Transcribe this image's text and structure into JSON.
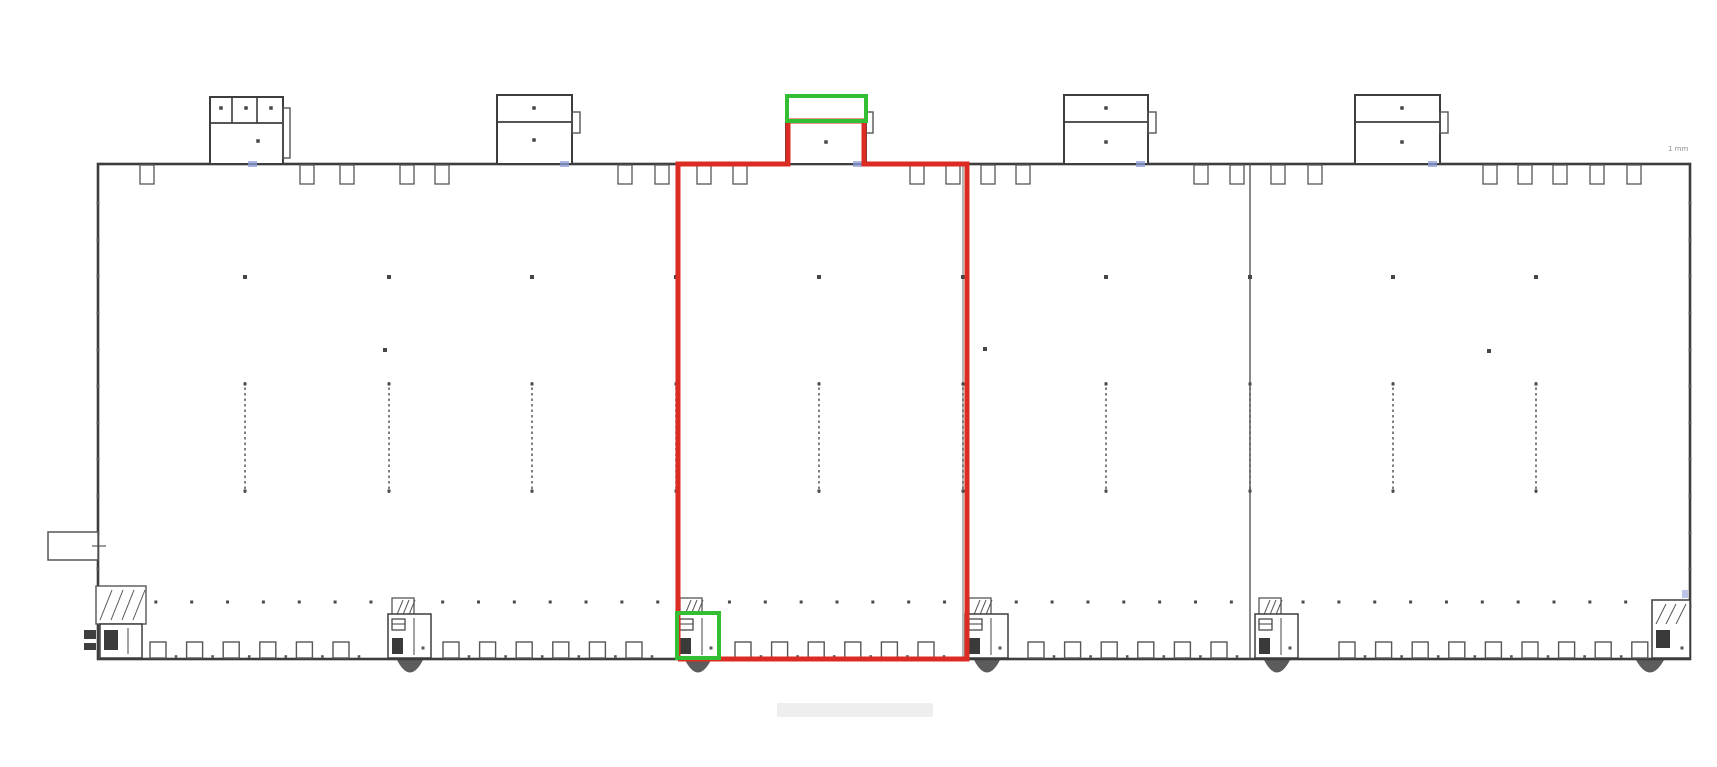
{
  "canvas": {
    "width": 1717,
    "height": 767,
    "background": "#ffffff"
  },
  "colors": {
    "wall": "#3d3d3d",
    "detail": "#565656",
    "light": "#7a7a7a",
    "highlight_red": "#dc2b23",
    "highlight_green": "#33bf33",
    "dim_blue": "#8f9fd8",
    "ghost": "#ececec",
    "note": "#8f8f8f"
  },
  "note": {
    "corner_label": "1 mm"
  },
  "building": {
    "left": 98,
    "top": 164,
    "right": 1690,
    "bottom": 659,
    "partition_x": 1250,
    "hidden_partitions": [
      676,
      963
    ]
  },
  "offices": [
    {
      "x": 210,
      "y": 97,
      "w": 73,
      "div_y": 123,
      "room_x": [
        232,
        257
      ],
      "dots": [
        [
          221,
          108
        ],
        [
          246,
          108
        ],
        [
          271,
          108
        ],
        [
          258,
          141
        ]
      ],
      "bump": {
        "x": 283,
        "y": 108,
        "w": 7,
        "h": 50
      }
    },
    {
      "x": 497,
      "y": 95,
      "w": 75,
      "div_y": 122,
      "room_x": [],
      "dots": [
        [
          534,
          108
        ],
        [
          534,
          140
        ]
      ],
      "bump": {
        "x": 572,
        "y": 112,
        "w": 8,
        "h": 21
      }
    },
    {
      "x": 786,
      "y": 95,
      "w": 80,
      "div_y": 122,
      "room_x": [],
      "dots": [
        [
          826,
          142
        ]
      ],
      "bump": {
        "x": 866,
        "y": 112,
        "w": 7,
        "h": 21
      }
    },
    {
      "x": 1064,
      "y": 95,
      "w": 84,
      "div_y": 122,
      "room_x": [],
      "dots": [
        [
          1106,
          108
        ],
        [
          1106,
          142
        ]
      ],
      "bump": {
        "x": 1148,
        "y": 112,
        "w": 8,
        "h": 21
      }
    },
    {
      "x": 1355,
      "y": 95,
      "w": 85,
      "div_y": 122,
      "room_x": [],
      "dots": [
        [
          1402,
          108
        ],
        [
          1402,
          142
        ]
      ],
      "bump": {
        "x": 1440,
        "y": 112,
        "w": 8,
        "h": 21
      }
    }
  ],
  "top_notches": {
    "w": 14,
    "h": 19,
    "xs": [
      140,
      300,
      340,
      400,
      435,
      618,
      655,
      697,
      733,
      910,
      946,
      981,
      1016,
      1194,
      1230,
      1271,
      1308,
      1483,
      1518,
      1553,
      1590,
      1627
    ]
  },
  "dock_doors": {
    "w": 16,
    "h": 17,
    "top_y": 642,
    "runs": [
      {
        "start": 150,
        "pitch": 36.6,
        "count": 6
      },
      {
        "start": 443,
        "pitch": 36.6,
        "count": 6
      },
      {
        "start": 735,
        "pitch": 36.6,
        "count": 6
      },
      {
        "start": 1028,
        "pitch": 36.6,
        "count": 6
      },
      {
        "start": 1339,
        "pitch": 36.6,
        "count": 9
      }
    ]
  },
  "rack_lines": {
    "y1": 382,
    "y2": 493,
    "xs": [
      245,
      389,
      532,
      676,
      819,
      963,
      1106,
      1250,
      1393,
      1536
    ]
  },
  "module_dots": {
    "y": 277
  },
  "sparse_dots": [
    [
      385,
      350
    ],
    [
      985,
      349
    ],
    [
      1489,
      351
    ]
  ],
  "bottom_dots": {
    "y": 602,
    "start": 120,
    "pitch": 35.85,
    "count": 44
  },
  "wall_ticks": {
    "ys": [
      203,
      240,
      276,
      313,
      350,
      386,
      423,
      459,
      496,
      533,
      569,
      606
    ]
  },
  "stairs_units": {
    "xs": [
      390,
      678,
      967,
      1257
    ]
  },
  "corner_left": {
    "hatch": {
      "x": 96,
      "y": 586,
      "w": 50,
      "h": 38
    },
    "box": {
      "x": 100,
      "y": 624,
      "w": 42,
      "h": 34
    },
    "glyph": {
      "x": 104,
      "y": 630,
      "w": 14,
      "h": 20
    },
    "outside_marks": [
      [
        84,
        630,
        12,
        9
      ],
      [
        84,
        643,
        12,
        7
      ]
    ]
  },
  "corner_right": {
    "box": {
      "x": 1652,
      "y": 600,
      "w": 38,
      "h": 58
    },
    "hatch": {
      "x": 1654,
      "y": 602,
      "w": 34,
      "h": 24
    },
    "glyph": {
      "x": 1656,
      "y": 630,
      "w": 14,
      "h": 18
    },
    "fan_cx": 1650
  },
  "left_canopy": {
    "x": 48,
    "y": 532,
    "w": 50,
    "h": 28
  },
  "ghost_bar": {
    "x": 777,
    "y": 703,
    "w": 156,
    "h": 14
  },
  "dim_ticks_x": [
    248,
    560,
    853,
    1136,
    1428
  ],
  "right_wall_dim_tick": {
    "x": 1682,
    "y": 590,
    "w": 6,
    "h": 8
  },
  "highlights": {
    "red_polygon": [
      [
        678,
        659
      ],
      [
        678,
        164
      ],
      [
        788,
        164
      ],
      [
        788,
        121
      ],
      [
        864,
        121
      ],
      [
        864,
        164
      ],
      [
        967,
        164
      ],
      [
        967,
        659
      ],
      [
        678,
        659
      ]
    ],
    "red_stroke_width": 5,
    "green_stroke_width": 4,
    "green_boxes": [
      {
        "x": 787,
        "y": 96,
        "w": 79,
        "h": 25
      },
      {
        "x": 677,
        "y": 613,
        "w": 42,
        "h": 45
      }
    ]
  }
}
